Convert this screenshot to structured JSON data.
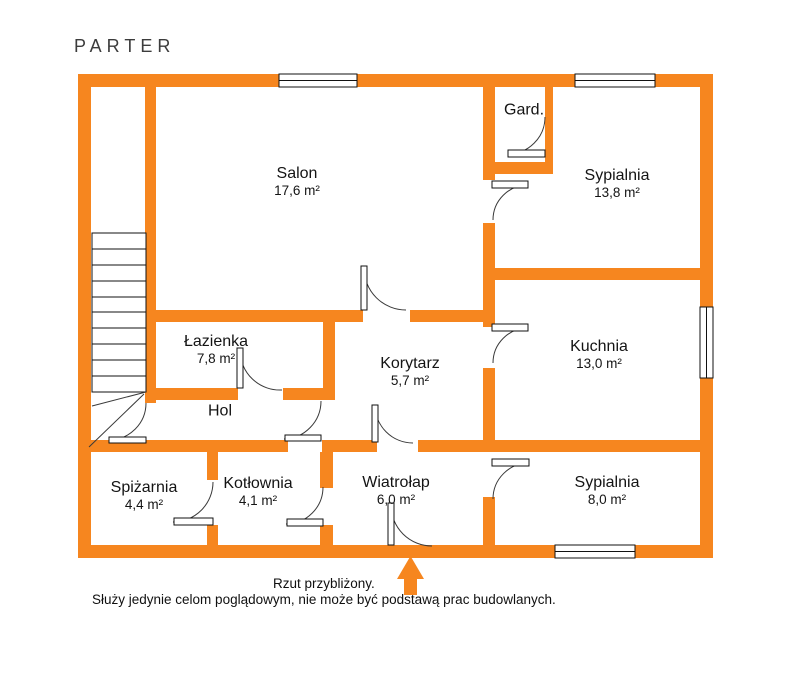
{
  "title": "PARTER",
  "colors": {
    "wall": "#F6861F",
    "line": "#3a3a3a",
    "text": "#141414"
  },
  "rooms": [
    {
      "name": "Salon",
      "area": "17,6 m²"
    },
    {
      "name": "Gard.",
      "area": ""
    },
    {
      "name": "Sypialnia",
      "area": "13,8 m²"
    },
    {
      "name": "Łazienka",
      "area": "7,8 m²"
    },
    {
      "name": "Korytarz",
      "area": "5,7 m²"
    },
    {
      "name": "Kuchnia",
      "area": "13,0 m²"
    },
    {
      "name": "Hol",
      "area": ""
    },
    {
      "name": "Spiżarnia",
      "area": "4,4 m²"
    },
    {
      "name": "Kotłownia",
      "area": "4,1 m²"
    },
    {
      "name": "Wiatrołap",
      "area": "6,0 m²"
    },
    {
      "name": "Sypialnia",
      "area": "8,0 m²"
    }
  ],
  "footer": {
    "line1": "Rzut przybliżony.",
    "line2": "Służy jedynie celom poglądowym, nie może być podstawą prac budowlanych."
  }
}
